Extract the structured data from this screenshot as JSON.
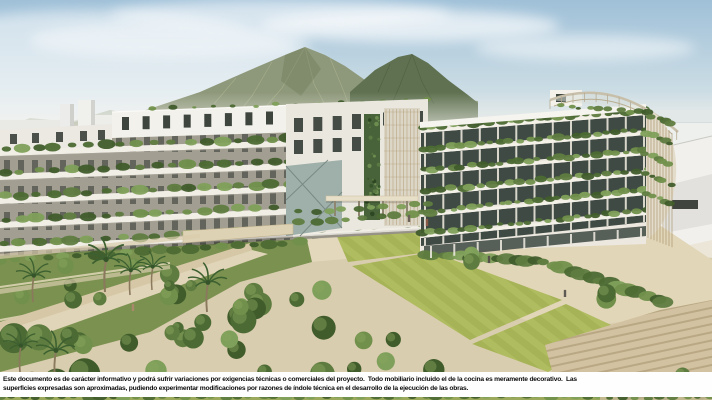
{
  "image": {
    "kind": "architectural rendering",
    "caption": "Aerial render of a modern residential complex: two white apartment buildings with plant-covered terraces around a landscaped courtyard with lawns, orchard trees and palm trees, green mountains and hazy sky behind"
  },
  "disclaimer": {
    "line1": "Este documento es de carácter informativo y podrá sufrir variaciones por exigencias técnicas o comerciales del proyecto.  Todo mobiliario incluido el de la cocina es meramente decorativo.  Las",
    "line2": "superficies expresadas son aproximadas, pudiendo experimentar modificaciones por razones de índole técnica en el desarrollo de la ejecución de las obras."
  },
  "palette": {
    "bar-bg": "#fefefe",
    "ink": "#0d0d0d",
    "sky-top": "#9fc0d8",
    "sky-horizon": "#f2f1ec",
    "mountain": "#8e987a",
    "mountain-dark": "#5f7150",
    "building-white": "#f1eee6",
    "balcony-green": "#5f7c40",
    "lawn": "#b0bc60",
    "paving": "#d9cdaf",
    "steps": "#d2c2a1"
  },
  "scene": {
    "elements": [
      "sky",
      "clouds",
      "mountains",
      "sea-horizon",
      "distant-buildings",
      "terraced-left-building",
      "green-balcony-right-building",
      "courtyard-lawn",
      "orchard-trees",
      "palm-trees",
      "walkway",
      "plaza-steps",
      "pedestrians",
      "disclaimer-text"
    ]
  }
}
